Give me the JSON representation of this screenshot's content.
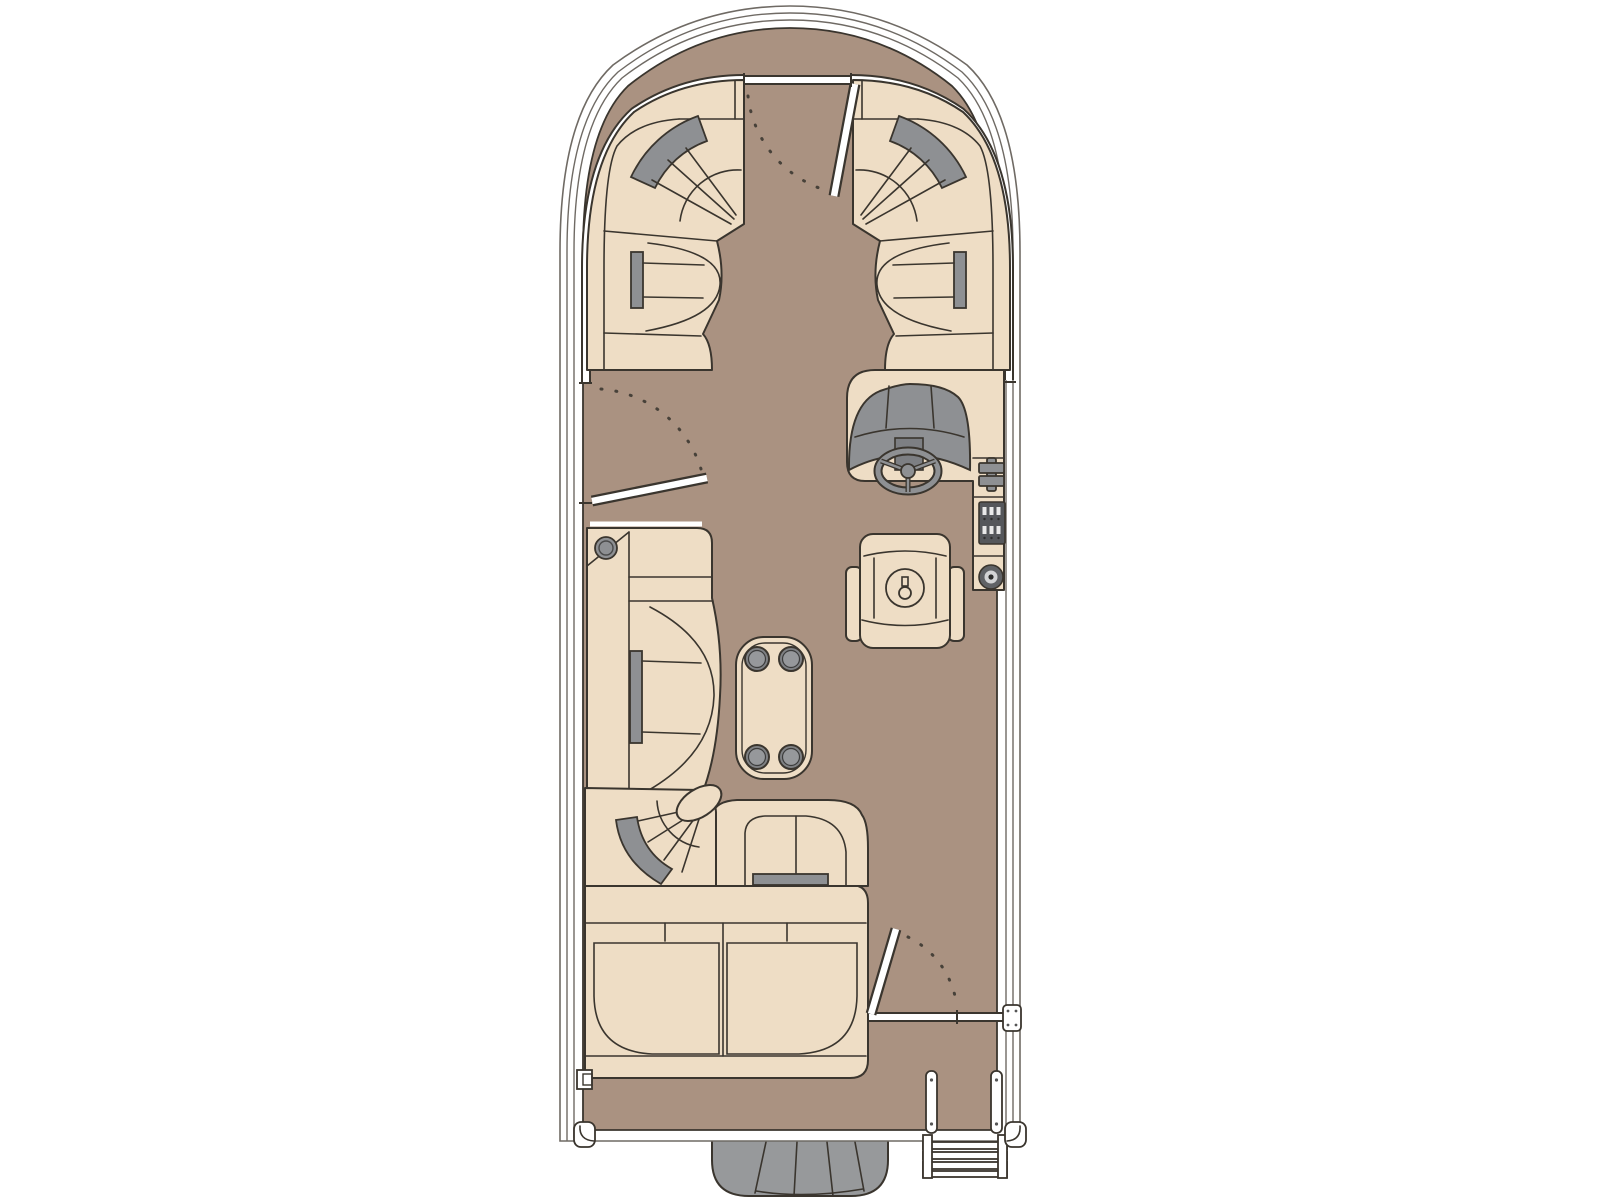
{
  "title": "Pontoon boat deck floor plan",
  "colors": {
    "deck": "#aa9281",
    "seat": "#eeddc5",
    "line": "#3a352e",
    "accent": "#8e9093",
    "panel_dark": "#55575b",
    "engine": "#97999b",
    "windshield": "#8e9093",
    "dash_center": "#7d7f83",
    "gauge_face": "#d3d4d6",
    "white": "#ffffff",
    "outline_soft": "#6f6a64",
    "swing": "#474139"
  },
  "components": [
    "hull-with-rail-fence",
    "bow-walkaround-deck",
    "bow-gate-with-swing-arc",
    "port-bow-wraparound-lounge",
    "starboard-bow-wraparound-lounge",
    "port-boarding-gate-with-swing-arc",
    "helm-console-with-windshield",
    "steering-wheel",
    "throttle-lever",
    "rocker-switch-panel",
    "helm-gauge",
    "captains-swivel-chair",
    "port-chaise-lounge-with-cupholder",
    "cocktail-table-with-four-cupholders",
    "stern-corner-wedge-seat",
    "aft-facing-lounge-seat",
    "stern-bench-seat",
    "stern-gate-with-swing-arc",
    "rear-boarding-deck",
    "boarding-ladder",
    "outboard-engine",
    "stern-cleats-and-brackets"
  ]
}
